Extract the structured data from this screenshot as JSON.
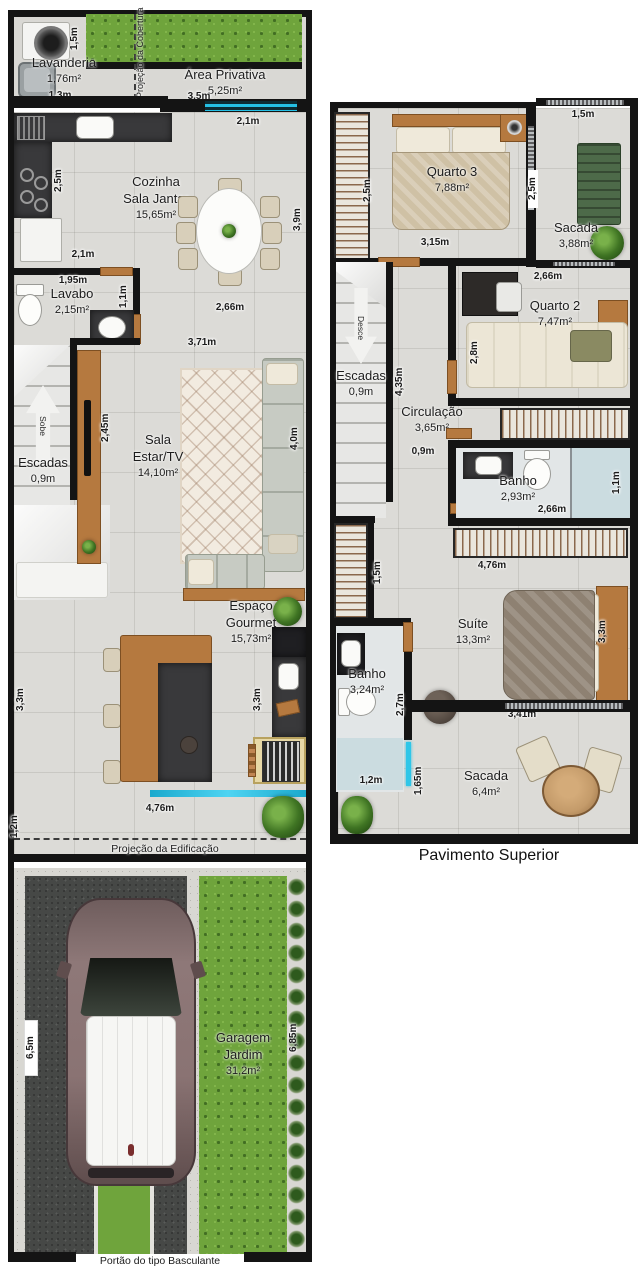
{
  "colors": {
    "wall": "#141414",
    "floor": "#dcdbd7",
    "counter": "#39393b",
    "wood": "#b5793f",
    "grass": "#6fa43c",
    "water_glass": "#25bfe4",
    "asphalt": "#464846",
    "concrete": "#d8d7d2"
  },
  "gf": {
    "lavanderia_name": "Lavanderia",
    "lavanderia_area": "1,76m²",
    "dim_lav_h": "1,5m",
    "dim_lav_w": "1,3m",
    "nota_cobertura": "Projeção da Cobertura",
    "privativa_name": "Área Privativa",
    "privativa_area": "5,25m²",
    "dim_privativa": "3,5m",
    "dim_entrada": "2,1m",
    "cozinha_name1": "Cozinha",
    "cozinha_name2": "Sala Jantar",
    "cozinha_area": "15,65m²",
    "dim_cozinha_h": "2,5m",
    "dim_cozinha_w": "2,1m",
    "dim_jantar_h": "3,9m",
    "dim_jantar_w": "2,66m",
    "lavabo_name": "Lavabo",
    "lavabo_area": "2,15m²",
    "dim_lavabo_w": "1,95m",
    "dim_lavabo_h": "1,1m",
    "escadas_name": "Escadas",
    "escadas_dim": "0,9m",
    "escadas_arrow": "Sobe",
    "dim_tv": "2,45m",
    "dim_sala_w": "3,71m",
    "dim_sala_h": "4,0m",
    "sala_name1": "Sala",
    "sala_name2": "Estar/TV",
    "sala_area": "14,10m²",
    "gourmet_name1": "Espaço",
    "gourmet_name2": "Gourmet",
    "gourmet_area": "15,73m²",
    "dim_gourmet_h1": "3,3m",
    "dim_gourmet_h2": "3,3m",
    "dim_gourmet_w": "4,76m",
    "dim_recuo": "1,2m",
    "nota_edificacao": "Projeção da Edificação",
    "garagem_name1": "Garagem",
    "garagem_name2": "Jardim",
    "garagem_area": "31,2m²",
    "dim_garagem_h": "6,5m",
    "dim_jardim_h": "6,85m",
    "nota_portao": "Portão do tipo Basculante"
  },
  "uf": {
    "caption": "Pavimento Superior",
    "quarto3_name": "Quarto 3",
    "quarto3_area": "7,88m²",
    "dim_q3_h": "2,5m",
    "dim_q3_w": "3,15m",
    "dim_sacada_sup_w": "1,5m",
    "dim_sacada_sup_h": "2,5m",
    "sacada_sup_name": "Sacada",
    "sacada_sup_area": "3,88m²",
    "dim_q2_w": "2,66m",
    "quarto2_name": "Quarto 2",
    "quarto2_area": "7,47m²",
    "dim_q2_h": "2,8m",
    "escadas_name": "Escadas",
    "escadas_dim": "0,9m",
    "escadas_arrow": "Desce",
    "dim_escadas_h": "4,35m",
    "circulacao_name": "Circulação",
    "circulacao_area": "3,65m²",
    "dim_circulacao": "0,9m",
    "banho_name": "Banho",
    "banho_area": "2,93m²",
    "dim_banho_h": "1,1m",
    "dim_banho_w": "2,66m",
    "dim_closet_esq": "1,5m",
    "dim_closet": "4,76m",
    "suite_name": "Suíte",
    "suite_area": "13,3m²",
    "dim_suite_h": "3,3m",
    "dim_suite_w": "3,41m",
    "banho_suite_name": "Banho",
    "banho_suite_area": "3,24m²",
    "dim_banho_suite_h": "2,7m",
    "dim_banho_suite_w": "1,2m",
    "dim_sacada_inf_h": "1,65m",
    "sacada_inf_name": "Sacada",
    "sacada_inf_area": "6,4m²"
  }
}
